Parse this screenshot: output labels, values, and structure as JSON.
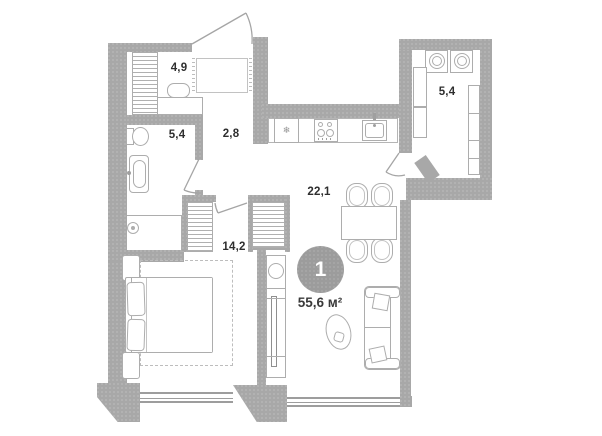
{
  "unit": {
    "number": "1",
    "total_area": "55,6 м²"
  },
  "rooms": [
    {
      "name": "dressing room",
      "area": "4,9"
    },
    {
      "name": "bathroom",
      "area": "5,4"
    },
    {
      "name": "hallway",
      "area": "2,8"
    },
    {
      "name": "laundry room",
      "area": "5,4"
    },
    {
      "name": "living room with kitchen",
      "area": "22,1"
    },
    {
      "name": "bedroom",
      "area": "14,2"
    }
  ],
  "icons": {
    "fridge": "❄"
  },
  "colors": {
    "wall": "#a8a8a8",
    "furniture_outline": "#adadad",
    "badge": "#9c9c9c",
    "text": "#2e2e2e"
  }
}
